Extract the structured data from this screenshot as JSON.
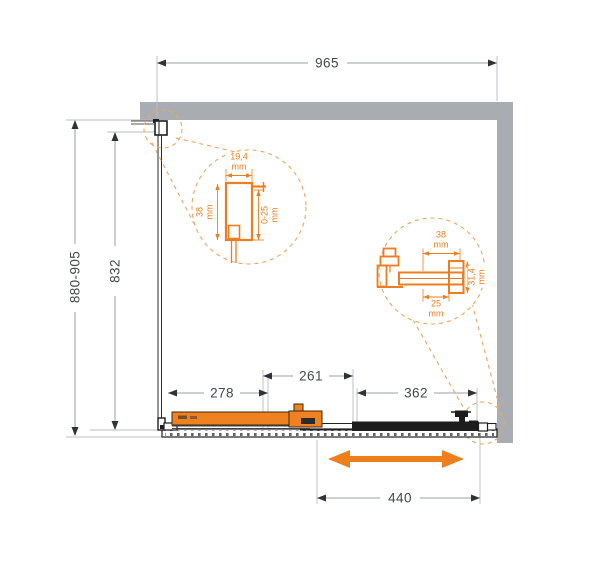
{
  "drawing_title": "Shower enclosure sliding door dimension drawing (top view)",
  "dimensions": {
    "top_width": "965",
    "left_height_range": "880-905",
    "left_glass_height": "832",
    "bottom_fixed_panel": "278",
    "bottom_overlap": "261",
    "bottom_door": "362",
    "bottom_travel": "440"
  },
  "detail_left_profile": {
    "width_value": "19,4",
    "width_unit": "mm",
    "depth_value": "38",
    "depth_unit": "mm",
    "adjust_value": "0-25",
    "adjust_unit": "mm"
  },
  "detail_roller_profile": {
    "top_value": "38",
    "top_unit": "mm",
    "side_value": "31,4",
    "side_unit": "mm",
    "bottom_value": "25",
    "bottom_unit": "mm"
  },
  "colors": {
    "accent_orange": "#EF7F1A",
    "callout_dash_orange": "#F2A35B",
    "wall_gray": "#A9ADB2",
    "line_dark": "#1E1E1E",
    "dim_line_gray": "#9AA0A6",
    "dim_text": "#43474B"
  }
}
